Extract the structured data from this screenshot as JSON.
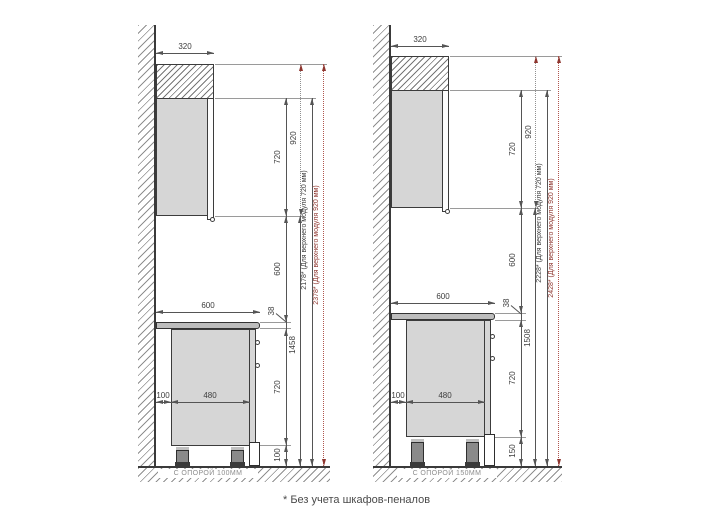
{
  "footnote": "* Без учета шкафов-пеналов",
  "accent_red": "#8e352e",
  "diagrams": [
    {
      "support_label": "С ОПОРОЙ 100ММ",
      "dims": {
        "upper_depth": "320",
        "upper_module_720": "720",
        "upper_module_920": "920",
        "counter_to_upper": "600",
        "counter_width": "600",
        "counter_thickness": "38",
        "base_height": "720",
        "leg_height": "100",
        "floor_to_upper": "1458",
        "total_720": "2178* (Для верхнего модуля 720 мм)",
        "total_920": "2378* (Для верхнего модуля 920 мм)",
        "wall_gap": "100",
        "base_depth": "480"
      }
    },
    {
      "support_label": "С ОПОРОЙ 150ММ",
      "dims": {
        "upper_depth": "320",
        "upper_module_720": "720",
        "upper_module_920": "920",
        "counter_to_upper": "600",
        "counter_width": "600",
        "counter_thickness": "38",
        "base_height": "720",
        "leg_height": "150",
        "floor_to_upper": "1508",
        "total_720": "2228* (Для верхнего модуля 720 мм)",
        "total_920": "2428* (Для верхнего модуля 920 мм)",
        "wall_gap": "100",
        "base_depth": "480"
      }
    }
  ]
}
